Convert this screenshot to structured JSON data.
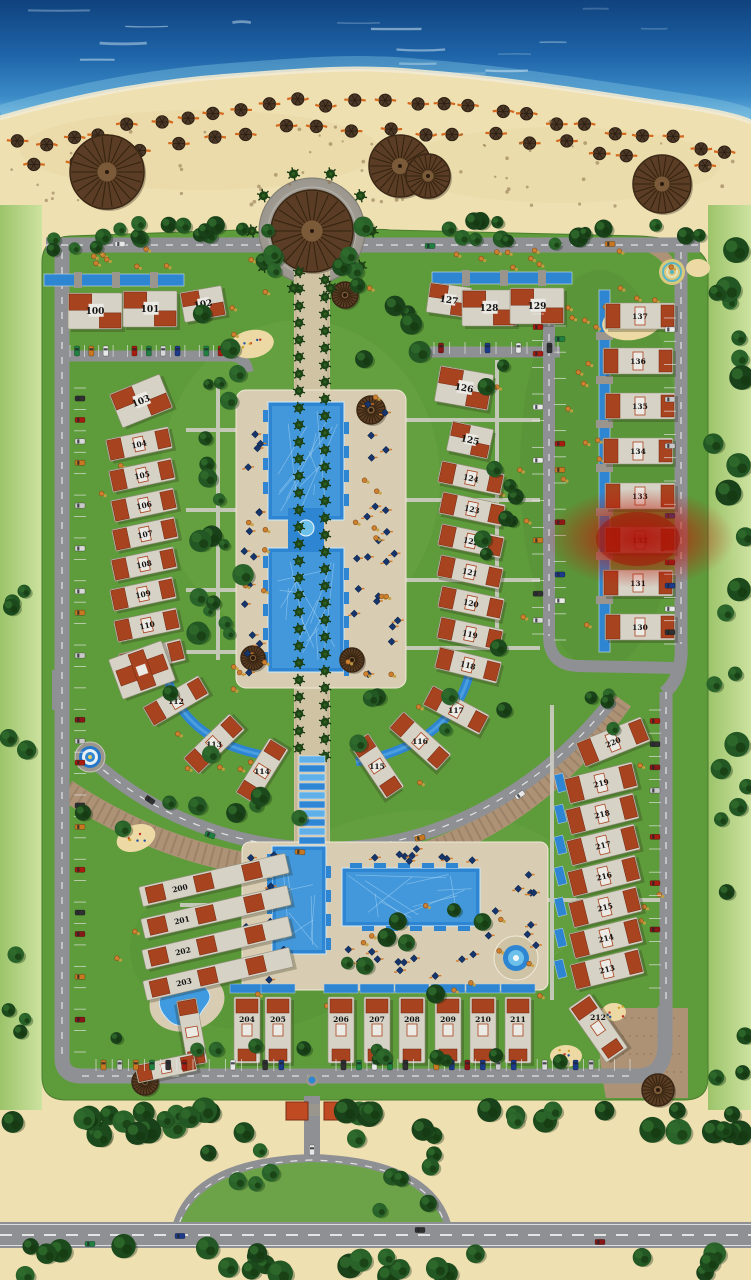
{
  "scene": {
    "type": "resort-master-plan",
    "description": "beachfront residential compound site plan, sea at top, highway at bottom",
    "highlighted_villa": "132"
  },
  "colors": {
    "sea": "#1e64a8",
    "sand": "#efe0b2",
    "grass": "#5e9b3b",
    "road": "#8e9094",
    "cobble": "#ad9276",
    "pool": "#2e86d2",
    "deck": "#d8cdb2",
    "roof": "#a8431f",
    "building": "#d6d2c6",
    "tree": "#235723",
    "highlight": "#c01608"
  },
  "villas": [
    {
      "label": "100",
      "x": 95,
      "y": 311,
      "a": 0,
      "t": "estate"
    },
    {
      "label": "101",
      "x": 150,
      "y": 309,
      "a": 0,
      "t": "estate"
    },
    {
      "label": "102",
      "x": 203,
      "y": 304,
      "a": -10,
      "t": "estateS"
    },
    {
      "label": "103",
      "x": 141,
      "y": 401,
      "a": -22,
      "t": "estate"
    },
    {
      "label": "104",
      "x": 139,
      "y": 444,
      "a": -12,
      "t": "row"
    },
    {
      "label": "105",
      "x": 142,
      "y": 475,
      "a": -12,
      "t": "row"
    },
    {
      "label": "106",
      "x": 144,
      "y": 505,
      "a": -12,
      "t": "row"
    },
    {
      "label": "107",
      "x": 145,
      "y": 534,
      "a": -12,
      "t": "row"
    },
    {
      "label": "108",
      "x": 144,
      "y": 564,
      "a": -12,
      "t": "row"
    },
    {
      "label": "109",
      "x": 143,
      "y": 594,
      "a": -12,
      "t": "row"
    },
    {
      "label": "110",
      "x": 147,
      "y": 625,
      "a": -12,
      "t": "row"
    },
    {
      "label": "111",
      "x": 152,
      "y": 657,
      "a": -14,
      "t": "row"
    },
    {
      "label": "112",
      "x": 176,
      "y": 701,
      "a": -30,
      "t": "row"
    },
    {
      "label": "113",
      "x": 214,
      "y": 744,
      "a": -44,
      "t": "row"
    },
    {
      "label": "114",
      "x": 262,
      "y": 771,
      "a": -58,
      "t": "row"
    },
    {
      "label": "115",
      "x": 377,
      "y": 766,
      "a": 56,
      "t": "row"
    },
    {
      "label": "116",
      "x": 420,
      "y": 741,
      "a": 42,
      "t": "row"
    },
    {
      "label": "117",
      "x": 456,
      "y": 710,
      "a": 28,
      "t": "row"
    },
    {
      "label": "118",
      "x": 468,
      "y": 665,
      "a": 14,
      "t": "row"
    },
    {
      "label": "119",
      "x": 470,
      "y": 634,
      "a": 12,
      "t": "row"
    },
    {
      "label": "120",
      "x": 471,
      "y": 603,
      "a": 12,
      "t": "row"
    },
    {
      "label": "121",
      "x": 470,
      "y": 572,
      "a": 12,
      "t": "row"
    },
    {
      "label": "122",
      "x": 471,
      "y": 541,
      "a": 12,
      "t": "row"
    },
    {
      "label": "123",
      "x": 472,
      "y": 509,
      "a": 12,
      "t": "row"
    },
    {
      "label": "124",
      "x": 471,
      "y": 478,
      "a": 12,
      "t": "row"
    },
    {
      "label": "125",
      "x": 470,
      "y": 440,
      "a": 12,
      "t": "estateS"
    },
    {
      "label": "126",
      "x": 464,
      "y": 388,
      "a": 10,
      "t": "estate"
    },
    {
      "label": "127",
      "x": 449,
      "y": 300,
      "a": 8,
      "t": "estateS"
    },
    {
      "label": "128",
      "x": 489,
      "y": 308,
      "a": 0,
      "t": "estate"
    },
    {
      "label": "129",
      "x": 537,
      "y": 306,
      "a": 0,
      "t": "estate"
    },
    {
      "label": "130",
      "x": 640,
      "y": 627,
      "a": 0,
      "t": "row2"
    },
    {
      "label": "131",
      "x": 638,
      "y": 583,
      "a": 0,
      "t": "row2"
    },
    {
      "label": "132",
      "x": 640,
      "y": 540,
      "a": 0,
      "t": "row2"
    },
    {
      "label": "133",
      "x": 640,
      "y": 496,
      "a": 0,
      "t": "row2"
    },
    {
      "label": "134",
      "x": 638,
      "y": 451,
      "a": 0,
      "t": "row2"
    },
    {
      "label": "135",
      "x": 640,
      "y": 406,
      "a": 0,
      "t": "row2"
    },
    {
      "label": "136",
      "x": 638,
      "y": 361,
      "a": 0,
      "t": "row2"
    },
    {
      "label": "137",
      "x": 640,
      "y": 316,
      "a": 0,
      "t": "row2"
    },
    {
      "label": "200",
      "x": 214,
      "y": 880,
      "a": -13,
      "t": "longrow"
    },
    {
      "label": "201",
      "x": 216,
      "y": 912,
      "a": -13,
      "t": "longrow"
    },
    {
      "label": "202",
      "x": 217,
      "y": 943,
      "a": -13,
      "t": "longrow"
    },
    {
      "label": "203",
      "x": 218,
      "y": 974,
      "a": -13,
      "t": "longrow"
    },
    {
      "label": "204",
      "x": 247,
      "y": 1030,
      "a": 0,
      "t": "vrow"
    },
    {
      "label": "205",
      "x": 278,
      "y": 1030,
      "a": 0,
      "t": "vrow"
    },
    {
      "label": "206",
      "x": 341,
      "y": 1030,
      "a": 0,
      "t": "vrow"
    },
    {
      "label": "207",
      "x": 377,
      "y": 1030,
      "a": 0,
      "t": "vrow"
    },
    {
      "label": "208",
      "x": 412,
      "y": 1030,
      "a": 0,
      "t": "vrow"
    },
    {
      "label": "209",
      "x": 448,
      "y": 1030,
      "a": 0,
      "t": "vrow"
    },
    {
      "label": "210",
      "x": 483,
      "y": 1030,
      "a": 0,
      "t": "vrow"
    },
    {
      "label": "211",
      "x": 518,
      "y": 1030,
      "a": 0,
      "t": "vrow"
    },
    {
      "label": "212",
      "x": 598,
      "y": 1028,
      "a": -35,
      "t": "vrow"
    },
    {
      "label": "213",
      "x": 607,
      "y": 969,
      "a": -14,
      "t": "row2"
    },
    {
      "label": "214",
      "x": 606,
      "y": 938,
      "a": -14,
      "t": "row2"
    },
    {
      "label": "215",
      "x": 605,
      "y": 907,
      "a": -14,
      "t": "row2"
    },
    {
      "label": "216",
      "x": 604,
      "y": 876,
      "a": -14,
      "t": "row2"
    },
    {
      "label": "217",
      "x": 603,
      "y": 845,
      "a": -14,
      "t": "row2"
    },
    {
      "label": "218",
      "x": 602,
      "y": 814,
      "a": -14,
      "t": "row2"
    },
    {
      "label": "219",
      "x": 601,
      "y": 783,
      "a": -14,
      "t": "row2"
    },
    {
      "label": "220",
      "x": 613,
      "y": 742,
      "a": -22,
      "t": "row2"
    }
  ],
  "facilities": [
    {
      "name": "entry-plaza-pavilion",
      "x": 312,
      "y": 231
    },
    {
      "name": "beach-pavilion-west",
      "x": 107,
      "y": 172
    },
    {
      "name": "beach-pavilion-center",
      "x": 400,
      "y": 166
    },
    {
      "name": "beach-pavilion-east",
      "x": 662,
      "y": 184
    },
    {
      "name": "clubhouse",
      "x": 142,
      "y": 670,
      "a": -20
    },
    {
      "name": "apartment-block",
      "x": 192,
      "y": 1032,
      "a": 80
    },
    {
      "name": "apartment-block-2",
      "x": 166,
      "y": 1068,
      "a": -12
    },
    {
      "name": "main-pool",
      "x": 306,
      "y": 538
    },
    {
      "name": "south-pool",
      "x": 400,
      "y": 897
    },
    {
      "name": "kids-pool",
      "x": 187,
      "y": 1002
    },
    {
      "name": "round-fountain",
      "x": 516,
      "y": 958
    },
    {
      "name": "spiral-garden",
      "x": 672,
      "y": 272
    },
    {
      "name": "west-roundabout",
      "x": 90,
      "y": 757
    },
    {
      "name": "south-gate",
      "x": 312,
      "y": 1110
    },
    {
      "name": "playground-north",
      "x": 252,
      "y": 344
    },
    {
      "name": "playground-east",
      "x": 632,
      "y": 322
    },
    {
      "name": "playground-west",
      "x": 136,
      "y": 838
    },
    {
      "name": "playground-south",
      "x": 566,
      "y": 1056
    }
  ]
}
